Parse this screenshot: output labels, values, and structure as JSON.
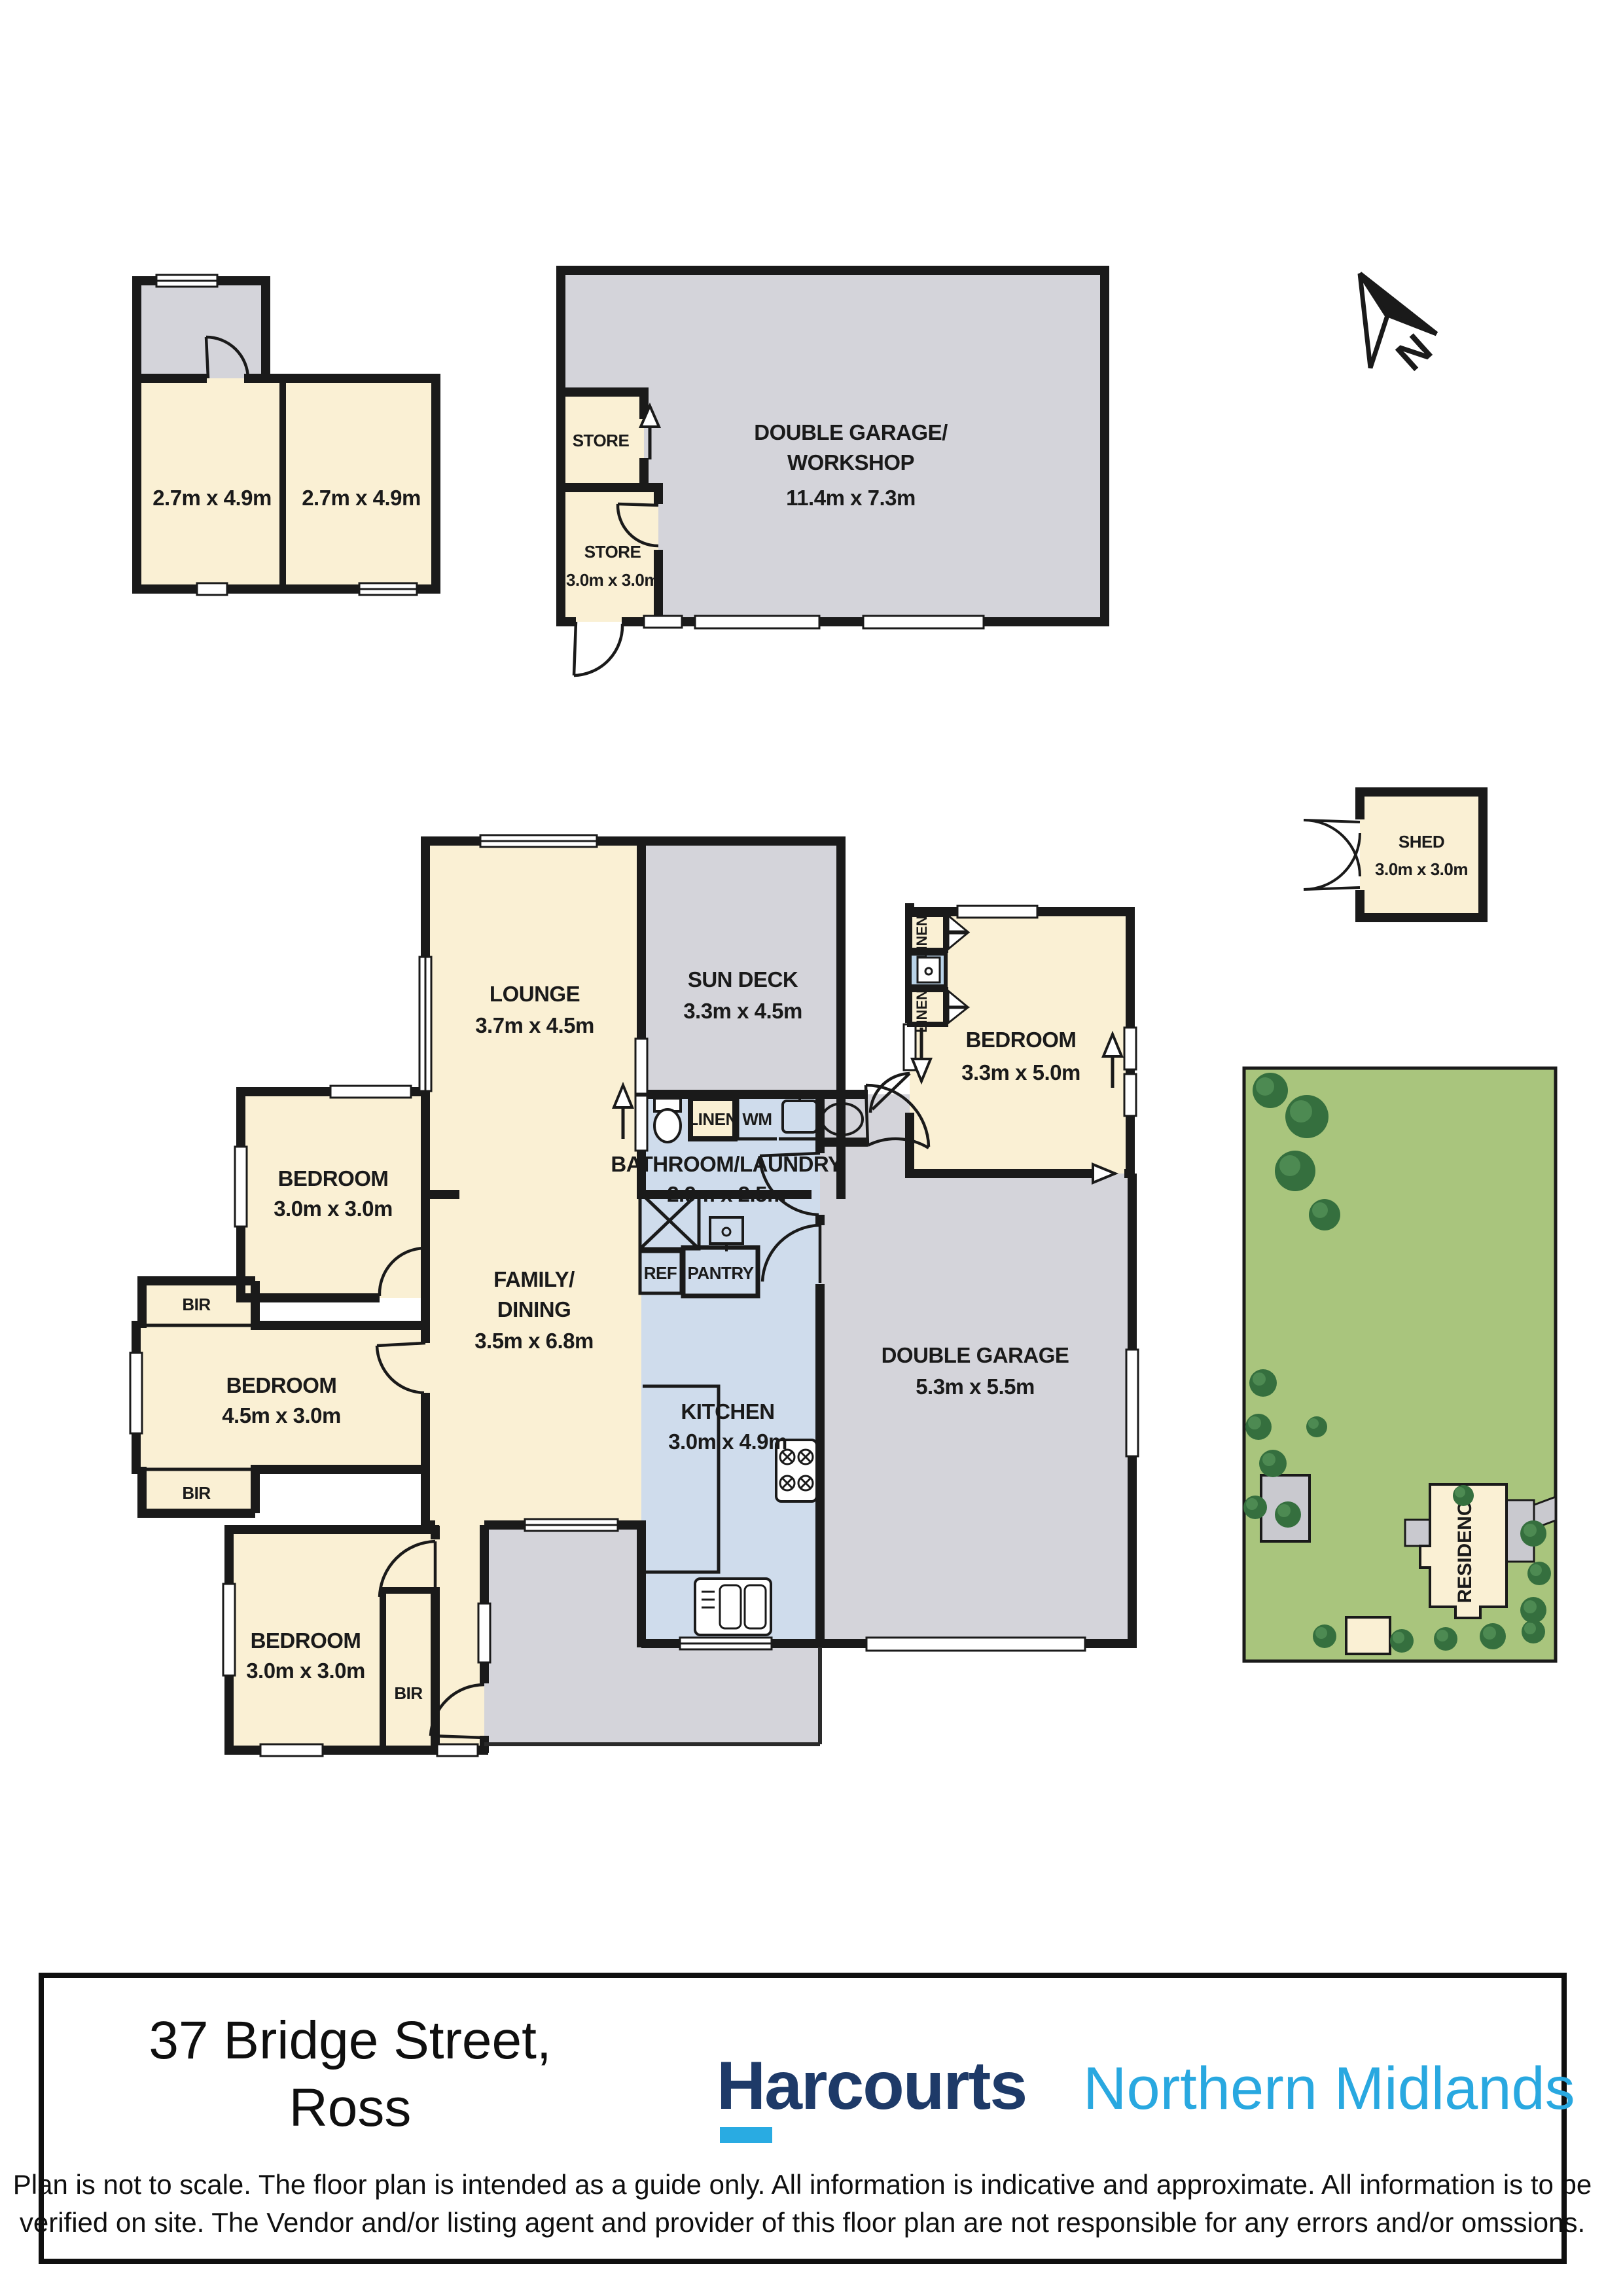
{
  "colors": {
    "wall": "#1a1a1a",
    "cream_room": "#faf0d4",
    "gray_area": "#d4d4da",
    "blue_room": "#cfdcec",
    "cabinet_blue": "#b9d3e8",
    "site_green": "#a9c57d",
    "tree_dark": "#356f3e",
    "tree_light": "#4d8a52",
    "brand_navy": "#1e3a68",
    "brand_cyan": "#29a8e0"
  },
  "t": {
    "a_room1": "2.7m x 4.9m",
    "a_room2": "2.7m x 4.9m",
    "store1": "STORE",
    "store2": "STORE",
    "store2_dim": "3.0m x 3.0m",
    "ws1": "DOUBLE GARAGE/",
    "ws2": "WORKSHOP",
    "ws_dim": "11.4m x 7.3m",
    "north": "N",
    "shed": "SHED",
    "shed_dim": "3.0m x 3.0m",
    "lounge": "LOUNGE",
    "lounge_dim": "3.7m x 4.5m",
    "sundeck": "SUN DECK",
    "sundeck_dim": "3.3m x 4.5m",
    "bed_r": "BEDROOM",
    "bed_r_dim": "3.3m x 5.0m",
    "linen_v1": "LINEN",
    "linen_v2": "LINEN",
    "bed_tl": "BEDROOM",
    "bed_tl_dim": "3.0m x 3.0m",
    "family1": "FAMILY/",
    "family2": "DINING",
    "family_dim": "3.5m x 6.8m",
    "bath": "BATHROOM/LAUNDRY",
    "bath_dim": "2.9m x 2.5m",
    "linen_h": "LINEN",
    "wm": "WM",
    "ref": "REF",
    "pantry": "PANTRY",
    "bed_ml": "BEDROOM",
    "bed_ml_dim": "4.5m x 3.0m",
    "bir1": "BIR",
    "bir2": "BIR",
    "bir3": "BIR",
    "bed_bl": "BEDROOM",
    "bed_bl_dim": "3.0m x 3.0m",
    "kitchen": "KITCHEN",
    "kitchen_dim": "3.0m x 4.9m",
    "garage": "DOUBLE GARAGE",
    "garage_dim": "5.3m x 5.5m",
    "residence": "RESIDENCE",
    "address1": "37 Bridge Street,",
    "address2": "Ross",
    "brand": "Harcourts",
    "brand_area": "Northern Midlands",
    "disc1": "Plan is not to scale. The floor plan is intended as a guide only. All information is indicative and approximate. All information is to be",
    "disc2": "verified on site. The Vendor and/or listing agent and provider of this floor plan are not responsible for any errors and/or omssions."
  }
}
